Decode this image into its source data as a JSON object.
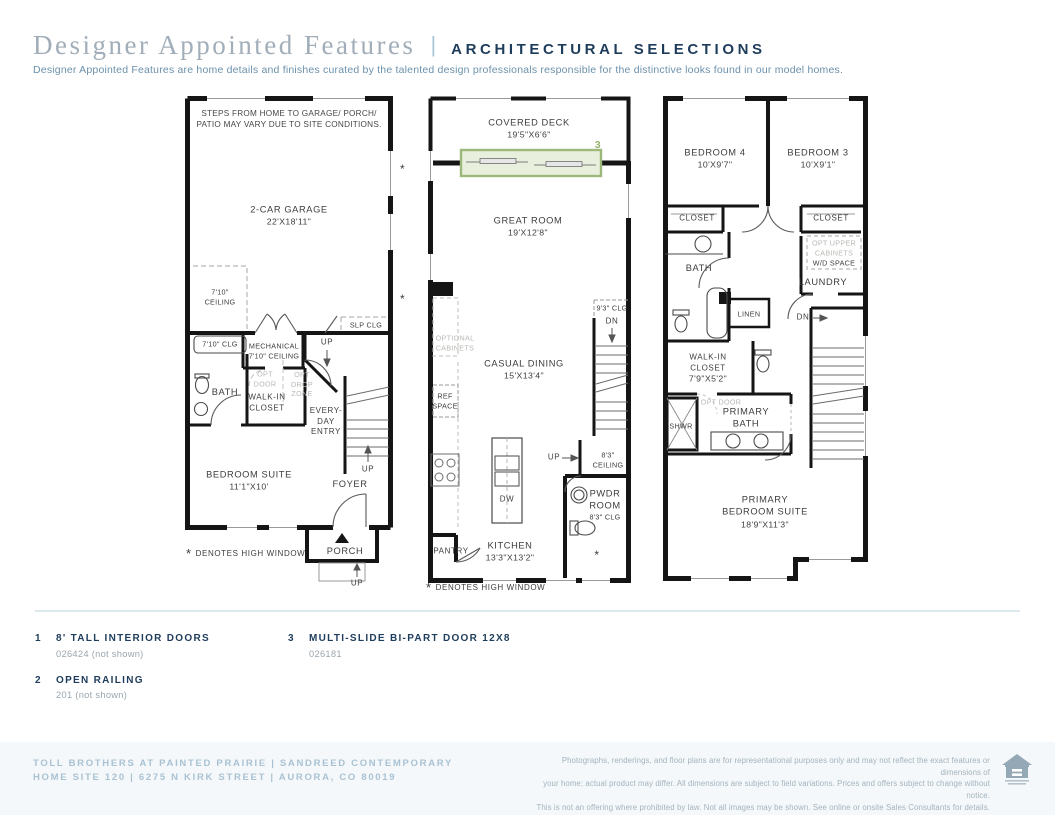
{
  "header": {
    "title": "Designer Appointed Features",
    "pipe": "|",
    "subtitle": "ARCHITECTURAL SELECTIONS",
    "tagline": "Designer Appointed Features are home details and finishes curated by the talented design professionals responsible for the distinctive looks found in our model homes."
  },
  "p1": {
    "note": [
      "STEPS FROM HOME TO GARAGE/ PORCH/",
      "PATIO MAY VARY DUE TO SITE CONDITIONS."
    ],
    "garage": [
      "2-CAR GARAGE",
      "22'X18'11\""
    ],
    "ceiling710": [
      "7'10\"",
      "CEILING"
    ],
    "slp": "SLP CLG",
    "clg710": "7'10\" CLG",
    "mech": [
      "MECHANICAL",
      "7'10\" CEILING"
    ],
    "up_top": "UP",
    "bath": "BATH",
    "optdoor": [
      "OPT",
      "DOOR"
    ],
    "walkin": [
      "WALK-IN",
      "CLOSET"
    ],
    "optdrop": [
      "OPT",
      "DROP",
      "ZONE"
    ],
    "everyday": [
      "EVERY-",
      "DAY",
      "ENTRY"
    ],
    "bedroom": [
      "BEDROOM SUITE",
      "11'1\"X10'"
    ],
    "foyer": "FOYER",
    "up_stair": "UP",
    "porch": "PORCH",
    "up_porch": "UP",
    "star": "*",
    "denotes": "DENOTES HIGH WINDOW"
  },
  "p2": {
    "deck": [
      "COVERED DECK",
      "19'5\"X6'6\""
    ],
    "tag3": "3",
    "great": [
      "GREAT ROOM",
      "19'X12'8\""
    ],
    "optcab": [
      "OPTIONAL",
      "CABINETS"
    ],
    "casual": [
      "CASUAL DINING",
      "15'X13'4\""
    ],
    "ref": [
      "REF",
      "SPACE"
    ],
    "clg93": "9'3\" CLG",
    "dn": "DN",
    "up": "UP",
    "ceil83": [
      "8'3\"",
      "CEILING"
    ],
    "pwdr": [
      "PWDR",
      "ROOM"
    ],
    "clg83": "8'3\" CLG",
    "dw": "DW",
    "kitchen": [
      "KITCHEN",
      "13'3\"X13'2\""
    ],
    "pantry": "PANTRY",
    "star": "*",
    "denotes": "DENOTES HIGH WINDOW"
  },
  "p3": {
    "bed4": [
      "BEDROOM 4",
      "10'X9'7\""
    ],
    "bed3": [
      "BEDROOM 3",
      "10'X9'1\""
    ],
    "closet": "CLOSET",
    "bath": "BATH",
    "optupper": [
      "OPT UPPER",
      "CABINETS"
    ],
    "wd": "W/D SPACE",
    "laundry": "LAUNDRY",
    "linen": "LINEN",
    "dn": "DN",
    "walkin": [
      "WALK-IN",
      "CLOSET",
      "7'9\"X5'2\""
    ],
    "optdoor": "OPT DOOR",
    "pbath": [
      "PRIMARY",
      "BATH"
    ],
    "shwr": "SHWR",
    "psuite": [
      "PRIMARY",
      "BEDROOM SUITE",
      "18'9\"X11'3\""
    ]
  },
  "legend": {
    "items": [
      {
        "num": "1",
        "title": "8' TALL INTERIOR DOORS",
        "detail": "026424 (not shown)"
      },
      {
        "num": "2",
        "title": "OPEN RAILING",
        "detail": "201 (not shown)"
      },
      {
        "num": "3",
        "title": "MULTI-SLIDE BI-PART DOOR 12X8",
        "detail": "026181"
      }
    ]
  },
  "footer": {
    "line1": "TOLL BROTHERS AT PAINTED PRAIRIE | SANDREED CONTEMPORARY",
    "line2": "HOME SITE 120 | 6275 N KIRK STREET | AURORA, CO 80019",
    "disclaimer": [
      "Photographs, renderings, and floor plans are for representational purposes only and may not reflect the exact features or dimensions of",
      "your home; actual product may differ. All dimensions are subject to field variations. Prices and offers subject to change without notice.",
      "This is not an offering where prohibited by law. Not all images may be shown. See online or onsite Sales Consultants for details."
    ]
  },
  "colors": {
    "navy": "#1e3c5b",
    "footer_blue": "#a9c2d3",
    "accent_green": "#9db87b",
    "wall_black": "#151515"
  }
}
